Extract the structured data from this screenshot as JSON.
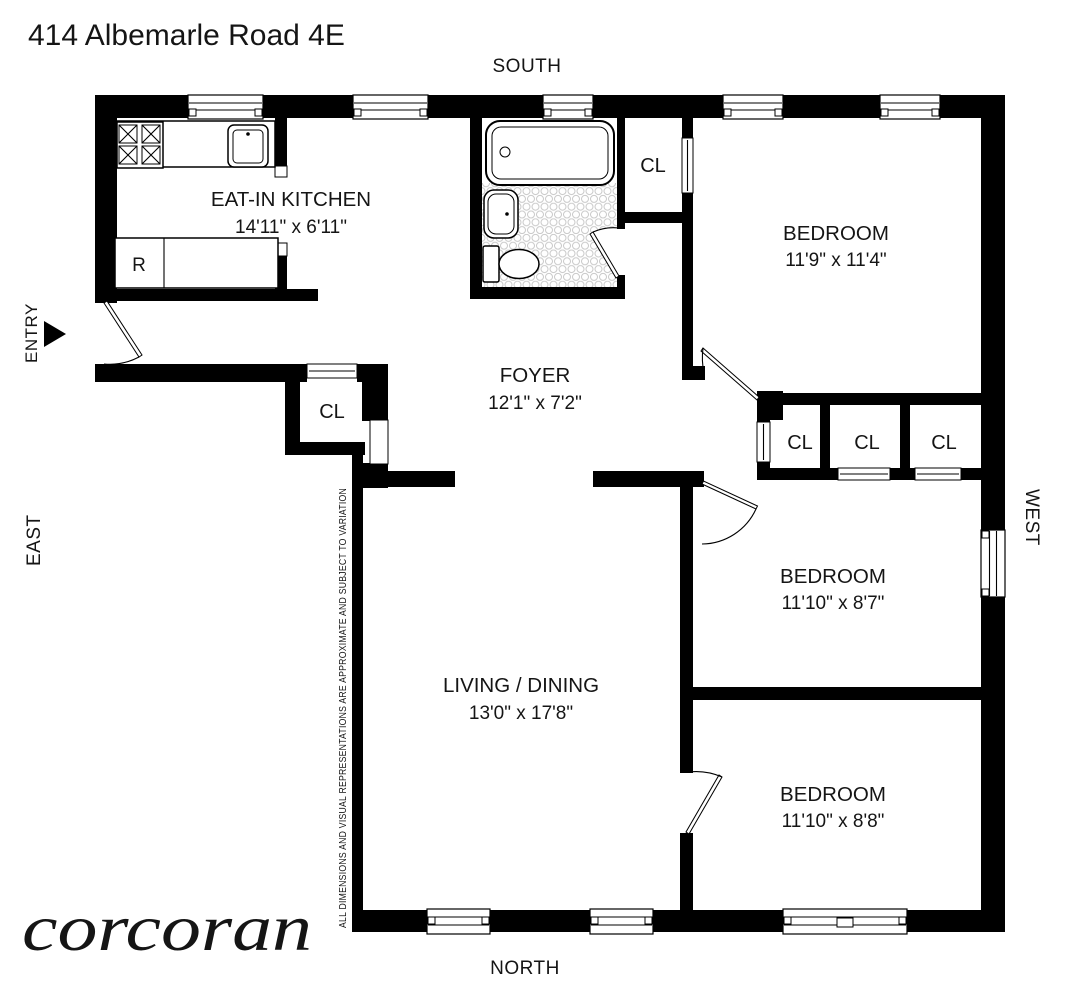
{
  "title": "414 Albemarle Road 4E",
  "brand_logo": "corcoran",
  "compass": {
    "south": "SOUTH",
    "north": "NORTH",
    "east": "EAST",
    "west": "WEST"
  },
  "entry": {
    "label": "ENTRY"
  },
  "rooms": {
    "kitchen": {
      "name": "EAT-IN KITCHEN",
      "dims": "14'11\" x 6'11\""
    },
    "foyer": {
      "name": "FOYER",
      "dims": "12'1\" x 7'2\""
    },
    "living_dining": {
      "name": "LIVING / DINING",
      "dims": "13'0\" x 17'8\""
    },
    "bedroom_south": {
      "name": "BEDROOM",
      "dims": "11'9\" x 11'4\""
    },
    "bedroom_west": {
      "name": "BEDROOM",
      "dims": "11'10\" x 8'7\""
    },
    "bedroom_north": {
      "name": "BEDROOM",
      "dims": "11'10\" x 8'8\""
    }
  },
  "labels": {
    "closet": "CL",
    "refrigerator": "R"
  },
  "disclaimer": "ALL DIMENSIONS AND VISUAL REPRESENTATIONS ARE APPROXIMATE AND SUBJECT TO VARIATION",
  "colors": {
    "walls": "#000000",
    "background": "#ffffff",
    "tile_dots": "#c9c9c9"
  }
}
